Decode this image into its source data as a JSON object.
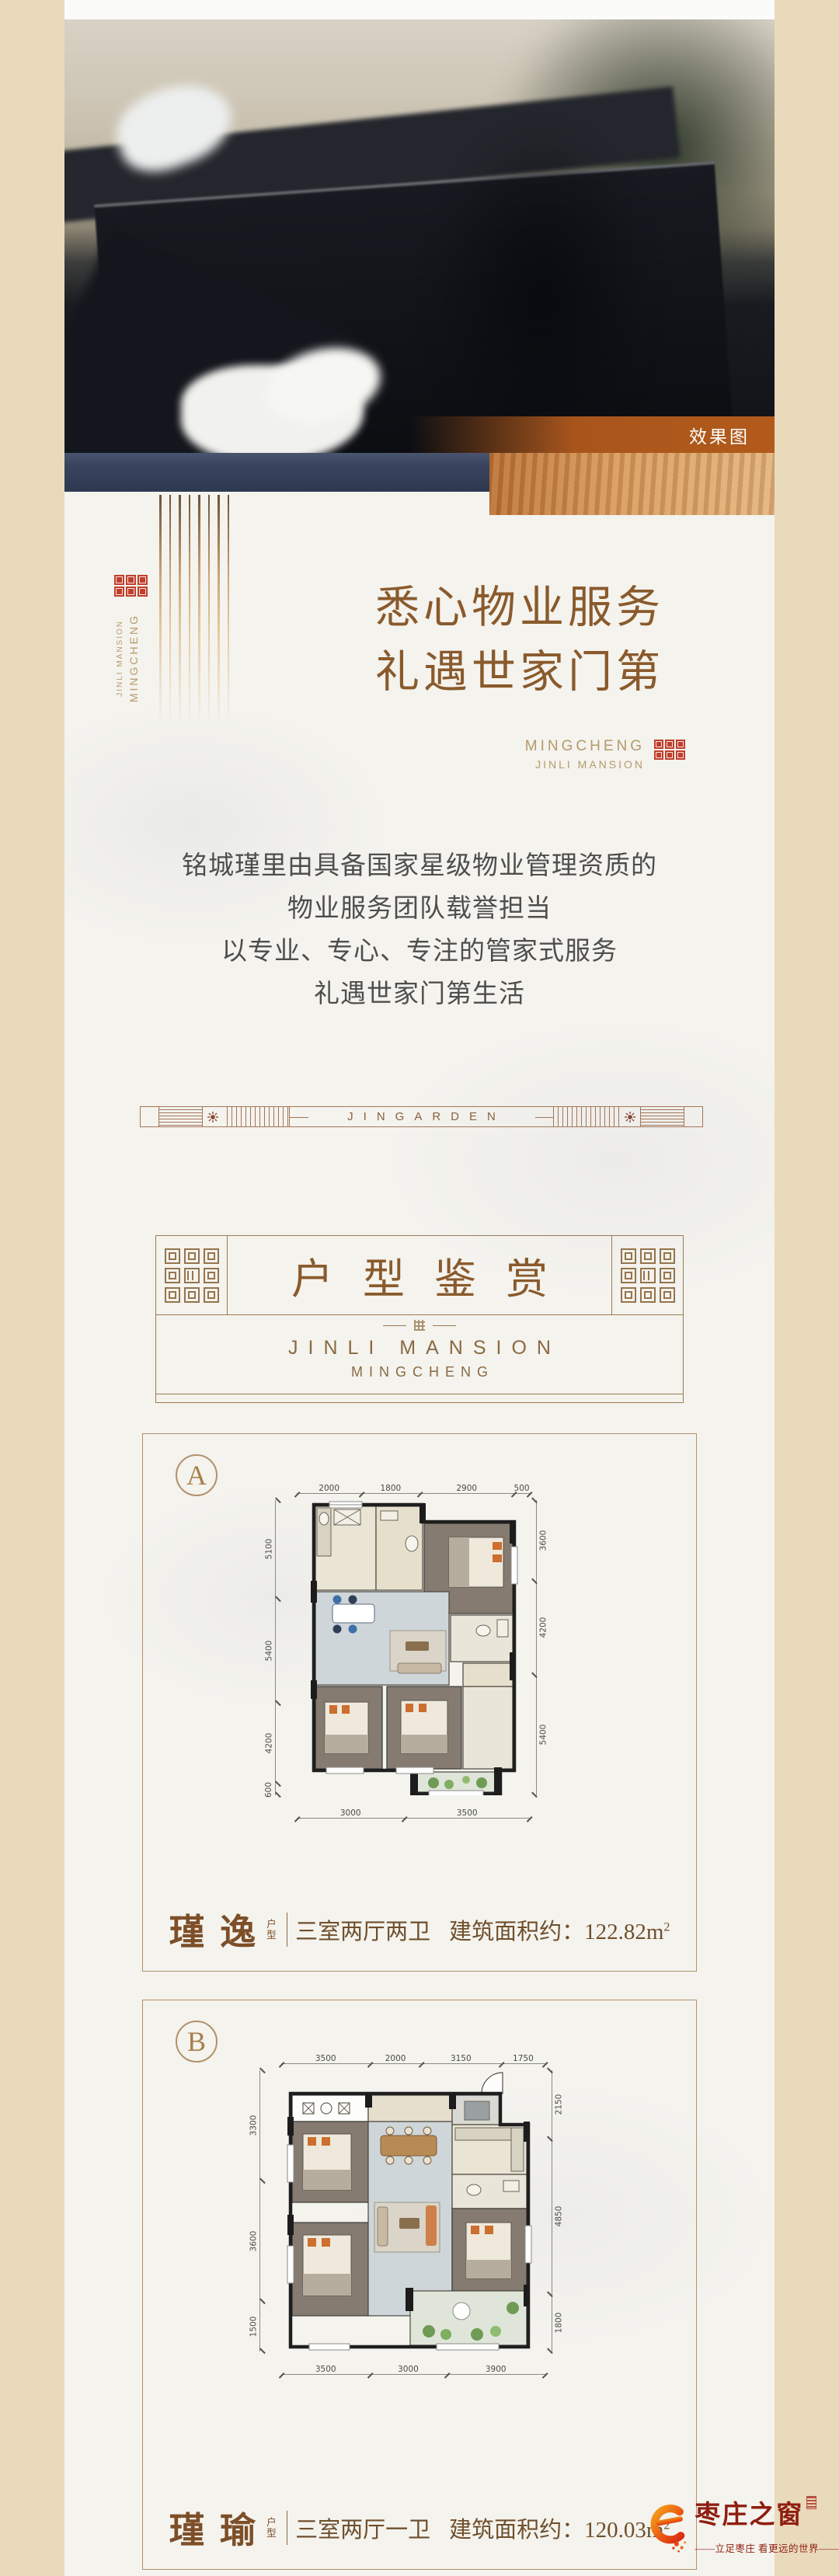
{
  "hero": {
    "tag_label": "效果图"
  },
  "brand_left": {
    "line_main": "MINGCHENG",
    "line_sub": "JINLI MANSION"
  },
  "service": {
    "title_line1": "悉心物业服务",
    "title_line2": "礼遇世家门第",
    "brand_line1": "MINGCHENG",
    "brand_line2": "JINLI MANSION",
    "body_lines": [
      "铭城瑾里由具备国家星级物业管理资质的",
      "物业服务团队载誉担当",
      "以专业、专心、专注的管家式服务",
      "礼遇世家门第生活"
    ]
  },
  "divider": {
    "label": "JINGARDEN"
  },
  "section_header": {
    "title": "户型鉴赏",
    "sub_line1": "JINLI MANSION",
    "sub_line2": "MINGCHENG"
  },
  "plan_a": {
    "badge": "A",
    "name": "瑾 逸",
    "name_tag": "户型",
    "rooms": "三室两厅两卫",
    "area_label": "建筑面积约：",
    "area_value": "122.82m",
    "area_sup": "2",
    "dims_top": [
      "2000",
      "1800",
      "2900",
      "500"
    ],
    "dims_bottom": [
      "3000",
      "3500"
    ],
    "dims_left": [
      "5100",
      "5400",
      "4200",
      "600"
    ],
    "dims_right": [
      "3600",
      "4200",
      "5400"
    ]
  },
  "plan_b": {
    "badge": "B",
    "name": "瑾 瑜",
    "name_tag": "户型",
    "rooms": "三室两厅一卫",
    "area_label": "建筑面积约：",
    "area_value": "120.03m",
    "area_sup": "2",
    "dims_top": [
      "3500",
      "2000",
      "3150",
      "1750"
    ],
    "dims_bottom": [
      "3500",
      "3000",
      "3900"
    ],
    "dims_left": [
      "3300",
      "3600",
      "1500"
    ],
    "dims_right": [
      "2150",
      "4850",
      "1800"
    ]
  },
  "watermark": {
    "site_name": "枣庄之窗",
    "tagline": "——立足枣庄 看更远的世界——"
  },
  "colors": {
    "page_bg": "#e9dabb",
    "paper": "#f4f3ee",
    "title_brown": "#8a5a2c",
    "gold": "#b59a67",
    "seal_red": "#bf3f2c",
    "navy_bar": "#39455f",
    "wood_orange": "#c9803f",
    "render_tag_bar": "#b25a1b",
    "watermark_red": "#8f1d10"
  }
}
